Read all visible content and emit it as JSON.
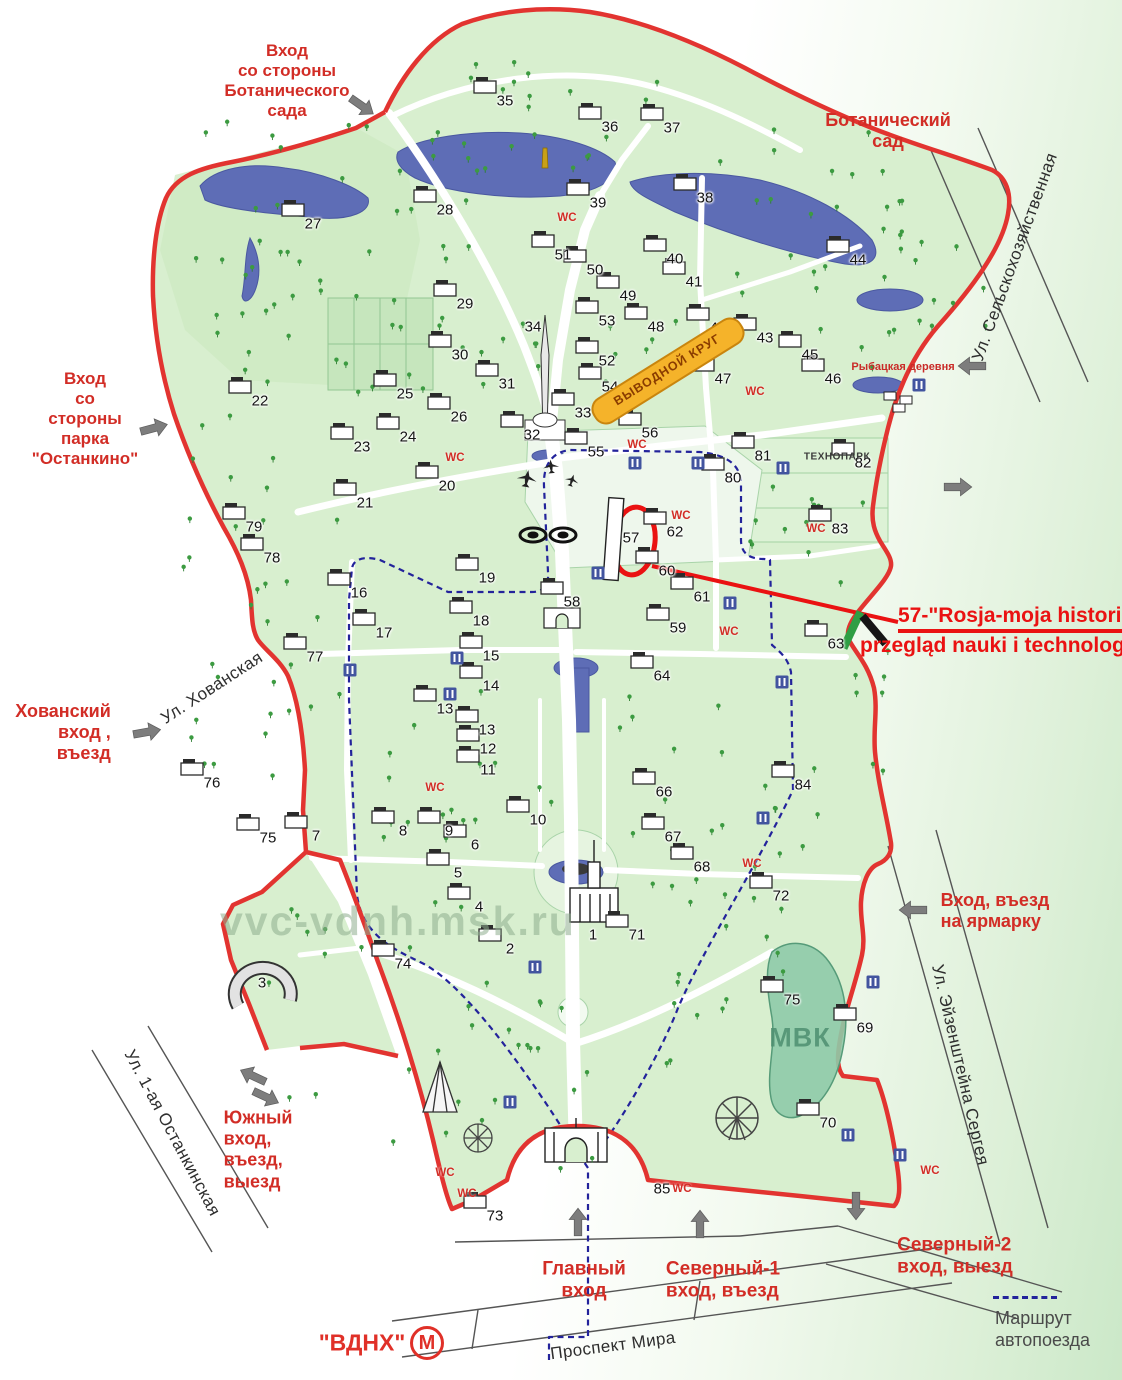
{
  "colors": {
    "boundary_red": "#e23430",
    "entrance_red": "#d22d26",
    "lake_blue": "#5e6db6",
    "route_blue": "#23239b",
    "park_green": "#d8efcf",
    "banner_yellow": "#f5b32a",
    "banner_border": "#c9850e",
    "banner_text": "#8a3c00",
    "annotation_red": "#ea1212",
    "metro_red": "#e03028",
    "watermark_green": "#8fae8f",
    "street_gray": "#555555"
  },
  "annotation": {
    "line1": "57-\"Rosja-moja historia\"",
    "line2": "przegląd nauki i technologii"
  },
  "specials": {
    "vyvodnoy_krug": {
      "text": "ВЫВОДНОЙ КРУГ",
      "x": 668,
      "y": 371,
      "rot": -32
    },
    "rybackaya": {
      "text": "Рыбацкая деревня",
      "x": 903,
      "y": 367
    },
    "technopark": {
      "text": "ТЕХНОПАРК",
      "x": 837,
      "y": 457
    },
    "mvk": {
      "text": "МВК",
      "x": 800,
      "y": 1038
    },
    "watermark": {
      "text": "vvc-vdnh.msk.ru",
      "x": 220,
      "y": 898
    }
  },
  "metro": {
    "station": "\"ВДНХ\"",
    "symbol": "М"
  },
  "legend": {
    "line1": "Маршрут",
    "line2": "автопоезда"
  },
  "wc_text": "WC",
  "entrances": [
    {
      "id": "botanical-entrance",
      "lines": [
        "Вход",
        "со стороны",
        "Ботанического",
        "сада"
      ],
      "x": 287,
      "y": 81,
      "align": "center",
      "size": 17
    },
    {
      "id": "botanical-garden",
      "lines": [
        "Ботанический",
        "сад"
      ],
      "x": 888,
      "y": 131,
      "align": "center",
      "size": 18
    },
    {
      "id": "ostankino-entrance",
      "lines": [
        "Вход",
        "со",
        "стороны",
        "парка",
        "\"Останкино\""
      ],
      "x": 85,
      "y": 419,
      "align": "center",
      "size": 17
    },
    {
      "id": "khovansky-entrance",
      "lines": [
        "Хованский",
        "вход ,",
        "въезд"
      ],
      "x": 63,
      "y": 733,
      "align": "right",
      "size": 18
    },
    {
      "id": "fair-entrance",
      "lines": [
        "Вход, въезд",
        "на ярмарку"
      ],
      "x": 995,
      "y": 911,
      "align": "left",
      "size": 18
    },
    {
      "id": "south-entrance",
      "lines": [
        "Южный",
        "вход,",
        "въезд,",
        "выезд"
      ],
      "x": 258,
      "y": 1150,
      "align": "left",
      "size": 18
    },
    {
      "id": "main-entrance",
      "lines": [
        "Главный",
        "вход"
      ],
      "x": 584,
      "y": 1281,
      "align": "center",
      "size": 19
    },
    {
      "id": "north1-entrance",
      "lines": [
        "Северный-1",
        "вход, въезд"
      ],
      "x": 723,
      "y": 1281,
      "align": "left",
      "size": 19
    },
    {
      "id": "north2-entrance",
      "lines": [
        "Северный-2",
        "вход, выезд"
      ],
      "x": 955,
      "y": 1257,
      "align": "left",
      "size": 19
    }
  ],
  "streets": [
    {
      "name": "Ул. Сельскохозяйственная",
      "x": 1015,
      "y": 257,
      "rot": -70
    },
    {
      "name": "Ул. Хованская",
      "x": 212,
      "y": 688,
      "rot": -33
    },
    {
      "name": "Ул. Эйзенштейна Сергея",
      "x": 960,
      "y": 1065,
      "rot": 77
    },
    {
      "name": "Ул. 1-ая Останкинская",
      "x": 172,
      "y": 1133,
      "rot": 62
    },
    {
      "name": "Проспект Мира",
      "x": 613,
      "y": 1346,
      "rot": -7.5
    }
  ],
  "numbers": [
    {
      "n": "1",
      "x": 593,
      "y": 935
    },
    {
      "n": "2",
      "x": 510,
      "y": 949
    },
    {
      "n": "3",
      "x": 262,
      "y": 983
    },
    {
      "n": "4",
      "x": 479,
      "y": 907
    },
    {
      "n": "5",
      "x": 458,
      "y": 873
    },
    {
      "n": "6",
      "x": 475,
      "y": 845
    },
    {
      "n": "7",
      "x": 316,
      "y": 836
    },
    {
      "n": "8",
      "x": 403,
      "y": 831
    },
    {
      "n": "9",
      "x": 449,
      "y": 831
    },
    {
      "n": "10",
      "x": 538,
      "y": 820
    },
    {
      "n": "11",
      "x": 488,
      "y": 770
    },
    {
      "n": "12",
      "x": 488,
      "y": 749
    },
    {
      "n": "13",
      "x": 445,
      "y": 709
    },
    {
      "n": "13",
      "x": 487,
      "y": 730
    },
    {
      "n": "14",
      "x": 491,
      "y": 686
    },
    {
      "n": "15",
      "x": 491,
      "y": 656
    },
    {
      "n": "16",
      "x": 359,
      "y": 593
    },
    {
      "n": "17",
      "x": 384,
      "y": 633
    },
    {
      "n": "18",
      "x": 481,
      "y": 621
    },
    {
      "n": "19",
      "x": 487,
      "y": 578
    },
    {
      "n": "20",
      "x": 447,
      "y": 486
    },
    {
      "n": "21",
      "x": 365,
      "y": 503
    },
    {
      "n": "22",
      "x": 260,
      "y": 401
    },
    {
      "n": "23",
      "x": 362,
      "y": 447
    },
    {
      "n": "24",
      "x": 408,
      "y": 437
    },
    {
      "n": "25",
      "x": 405,
      "y": 394
    },
    {
      "n": "26",
      "x": 459,
      "y": 417
    },
    {
      "n": "27",
      "x": 313,
      "y": 224
    },
    {
      "n": "28",
      "x": 445,
      "y": 210
    },
    {
      "n": "29",
      "x": 465,
      "y": 304
    },
    {
      "n": "30",
      "x": 460,
      "y": 355
    },
    {
      "n": "31",
      "x": 507,
      "y": 384
    },
    {
      "n": "32",
      "x": 532,
      "y": 435
    },
    {
      "n": "33",
      "x": 583,
      "y": 413
    },
    {
      "n": "34",
      "x": 533,
      "y": 327
    },
    {
      "n": "35",
      "x": 505,
      "y": 101
    },
    {
      "n": "36",
      "x": 610,
      "y": 127
    },
    {
      "n": "37",
      "x": 672,
      "y": 128
    },
    {
      "n": "38",
      "x": 705,
      "y": 198
    },
    {
      "n": "39",
      "x": 598,
      "y": 203
    },
    {
      "n": "40",
      "x": 675,
      "y": 259
    },
    {
      "n": "41",
      "x": 694,
      "y": 282
    },
    {
      "n": "42",
      "x": 718,
      "y": 328
    },
    {
      "n": "43",
      "x": 765,
      "y": 338
    },
    {
      "n": "44",
      "x": 858,
      "y": 260
    },
    {
      "n": "45",
      "x": 810,
      "y": 355
    },
    {
      "n": "46",
      "x": 833,
      "y": 379
    },
    {
      "n": "47",
      "x": 723,
      "y": 379
    },
    {
      "n": "48",
      "x": 656,
      "y": 327
    },
    {
      "n": "49",
      "x": 628,
      "y": 296
    },
    {
      "n": "50",
      "x": 595,
      "y": 270
    },
    {
      "n": "51",
      "x": 563,
      "y": 255
    },
    {
      "n": "52",
      "x": 607,
      "y": 361
    },
    {
      "n": "53",
      "x": 607,
      "y": 321
    },
    {
      "n": "54",
      "x": 610,
      "y": 387
    },
    {
      "n": "55",
      "x": 596,
      "y": 452
    },
    {
      "n": "56",
      "x": 650,
      "y": 433
    },
    {
      "n": "57",
      "x": 631,
      "y": 538
    },
    {
      "n": "58",
      "x": 572,
      "y": 602
    },
    {
      "n": "59",
      "x": 678,
      "y": 628
    },
    {
      "n": "60",
      "x": 667,
      "y": 571
    },
    {
      "n": "61",
      "x": 702,
      "y": 597
    },
    {
      "n": "62",
      "x": 675,
      "y": 532
    },
    {
      "n": "63",
      "x": 836,
      "y": 644
    },
    {
      "n": "64",
      "x": 662,
      "y": 676
    },
    {
      "n": "66",
      "x": 664,
      "y": 792
    },
    {
      "n": "67",
      "x": 673,
      "y": 837
    },
    {
      "n": "68",
      "x": 702,
      "y": 867
    },
    {
      "n": "69",
      "x": 865,
      "y": 1028
    },
    {
      "n": "70",
      "x": 828,
      "y": 1123
    },
    {
      "n": "71",
      "x": 637,
      "y": 935
    },
    {
      "n": "72",
      "x": 781,
      "y": 896
    },
    {
      "n": "73",
      "x": 495,
      "y": 1216
    },
    {
      "n": "74",
      "x": 403,
      "y": 964
    },
    {
      "n": "75",
      "x": 268,
      "y": 838
    },
    {
      "n": "75",
      "x": 792,
      "y": 1000
    },
    {
      "n": "76",
      "x": 212,
      "y": 783
    },
    {
      "n": "77",
      "x": 315,
      "y": 657
    },
    {
      "n": "78",
      "x": 272,
      "y": 558
    },
    {
      "n": "79",
      "x": 254,
      "y": 527
    },
    {
      "n": "80",
      "x": 733,
      "y": 478
    },
    {
      "n": "81",
      "x": 763,
      "y": 456
    },
    {
      "n": "82",
      "x": 863,
      "y": 463
    },
    {
      "n": "83",
      "x": 840,
      "y": 529
    },
    {
      "n": "84",
      "x": 803,
      "y": 785
    },
    {
      "n": "85",
      "x": 662,
      "y": 1189
    }
  ],
  "wc_labels": [
    {
      "x": 567,
      "y": 218
    },
    {
      "x": 455,
      "y": 458
    },
    {
      "x": 755,
      "y": 392
    },
    {
      "x": 637,
      "y": 445
    },
    {
      "x": 681,
      "y": 516
    },
    {
      "x": 816,
      "y": 529
    },
    {
      "x": 435,
      "y": 788
    },
    {
      "x": 729,
      "y": 632
    },
    {
      "x": 752,
      "y": 864
    },
    {
      "x": 445,
      "y": 1173
    },
    {
      "x": 467,
      "y": 1194
    },
    {
      "x": 682,
      "y": 1189
    },
    {
      "x": 930,
      "y": 1171
    }
  ],
  "amenity_icons": [
    {
      "x": 635,
      "y": 463
    },
    {
      "x": 698,
      "y": 463
    },
    {
      "x": 783,
      "y": 468
    },
    {
      "x": 598,
      "y": 573
    },
    {
      "x": 457,
      "y": 658
    },
    {
      "x": 450,
      "y": 694
    },
    {
      "x": 782,
      "y": 682
    },
    {
      "x": 350,
      "y": 670
    },
    {
      "x": 763,
      "y": 818
    },
    {
      "x": 873,
      "y": 982
    },
    {
      "x": 848,
      "y": 1135
    },
    {
      "x": 900,
      "y": 1155
    },
    {
      "x": 510,
      "y": 1102
    },
    {
      "x": 919,
      "y": 385
    },
    {
      "x": 730,
      "y": 603
    },
    {
      "x": 535,
      "y": 967
    }
  ]
}
